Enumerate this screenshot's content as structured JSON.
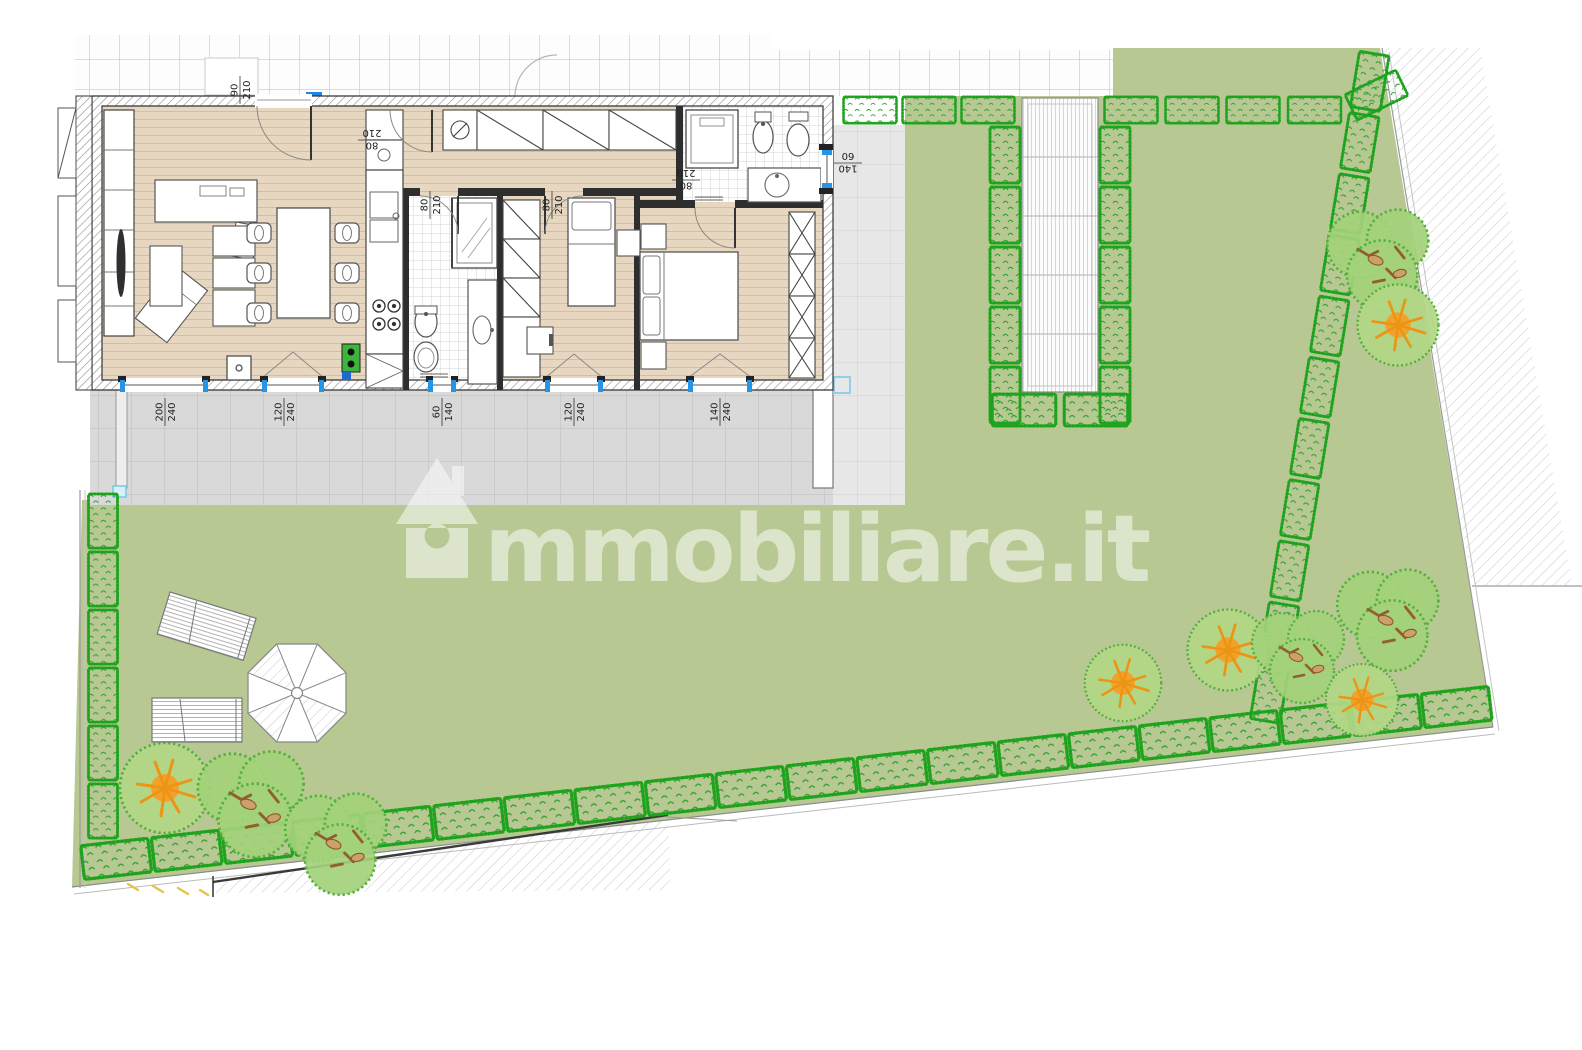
{
  "watermark": {
    "text": "mmobiliare.it",
    "icon_name": "immobiliare-house-logo",
    "color": "#ffffff"
  },
  "colors": {
    "lawn": "#b7c892",
    "hedge_green": "#1fa31f",
    "tree_canopy": "#9ecd74",
    "tree_accent_orange": "#f0a12c",
    "wood_floor": "#e7d7c0",
    "patio_gray": "#d9d9d9",
    "patio_light_gray": "#e7e7e7",
    "window_blue": "#2894e8",
    "marker_blue": "#1e86e0",
    "marker_light_blue": "#8fd0e8"
  },
  "dimension_labels": [
    {
      "id": "entrance-door",
      "a": "90",
      "b": "210"
    },
    {
      "id": "hall-door",
      "a": "80",
      "b": "210"
    },
    {
      "id": "bath1-door",
      "a": "80",
      "b": "210"
    },
    {
      "id": "bedroom1-door",
      "a": "80",
      "b": "210"
    },
    {
      "id": "bedroom2-door",
      "a": "80",
      "b": "210"
    },
    {
      "id": "bath2-window",
      "a": "140",
      "b": "60"
    },
    {
      "id": "living-window-large",
      "a": "200",
      "b": "240"
    },
    {
      "id": "living-window-small",
      "a": "120",
      "b": "240"
    },
    {
      "id": "bath1-window",
      "a": "60",
      "b": "140"
    },
    {
      "id": "bedroom1-window",
      "a": "120",
      "b": "240"
    },
    {
      "id": "bedroom2-window",
      "a": "140",
      "b": "240"
    }
  ]
}
